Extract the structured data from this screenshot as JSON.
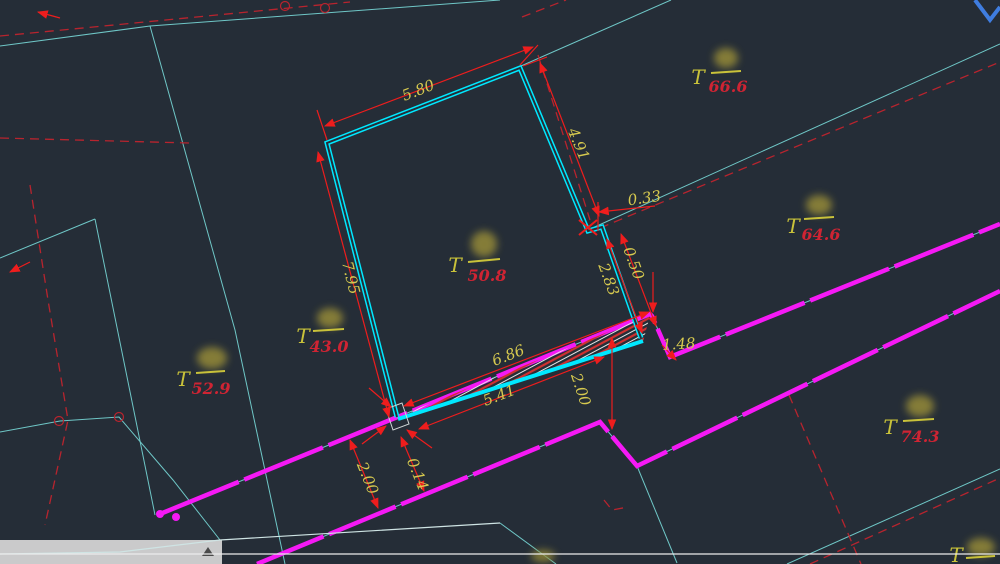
{
  "view": {
    "type": "cad-drawing-viewport",
    "description": "cadastral survey plan with building outline, road edges and dimensions"
  },
  "colors": {
    "background": "#252d37",
    "parcel_line": "#6fc7c7",
    "building_line": "#00e8ff",
    "road_line": "#f519f5",
    "dim_line": "#ee1d1d",
    "dashed_boundary": "#b8242e",
    "dim_text": "#d6c94f",
    "label_t": "#c9c23a",
    "label_area": "#cf2433",
    "blue_line": "#3f7de0",
    "panel": "#d3d3d3"
  },
  "dimensions": [
    {
      "name": "building-top-width",
      "value": "5.80"
    },
    {
      "name": "building-right-upper",
      "value": "4.91"
    },
    {
      "name": "wall-jog-offset",
      "value": "0.33"
    },
    {
      "name": "right-step",
      "value": "0.50"
    },
    {
      "name": "right-lower",
      "value": "2.83"
    },
    {
      "name": "building-left-side",
      "value": "7.95"
    },
    {
      "name": "bottom-outer",
      "value": "6.86"
    },
    {
      "name": "bottom-inner",
      "value": "5.41"
    },
    {
      "name": "road-jog",
      "value": "1.48"
    },
    {
      "name": "road-width-right",
      "value": "2.00"
    },
    {
      "name": "road-width-left",
      "value": "2.00"
    },
    {
      "name": "road-edge-gap",
      "value": "0.14"
    }
  ],
  "parcels": [
    {
      "name": "center",
      "prefix": "T",
      "area": "50.8"
    },
    {
      "name": "top-right",
      "prefix": "T",
      "area": "66.6"
    },
    {
      "name": "mid-right",
      "prefix": "T",
      "area": "64.6"
    },
    {
      "name": "mid-left",
      "prefix": "T",
      "area": "43.0"
    },
    {
      "name": "lower-left",
      "prefix": "T",
      "area": "52.9"
    },
    {
      "name": "lower-right",
      "prefix": "T",
      "area": "74.3"
    },
    {
      "name": "bottom-edge",
      "prefix": "T",
      "area": ""
    }
  ]
}
